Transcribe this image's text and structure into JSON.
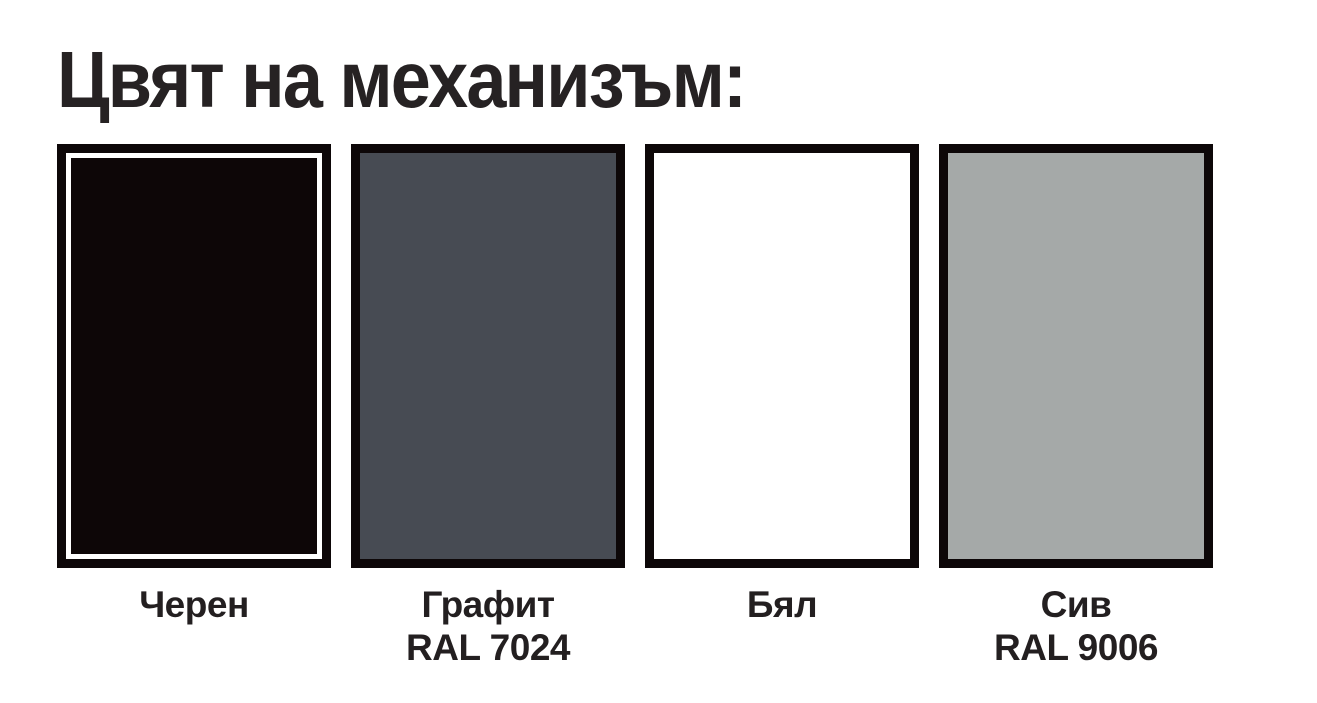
{
  "title": "Цвят на механизъм:",
  "swatches": [
    {
      "label": "Черен",
      "ral": "",
      "color": "#0d0607",
      "inner_ring_color": "#ffffff"
    },
    {
      "label": "Графит",
      "ral": "RAL 7024",
      "color": "#474b53",
      "inner_ring_color": ""
    },
    {
      "label": "Бял",
      "ral": "",
      "color": "#ffffff",
      "inner_ring_color": ""
    },
    {
      "label": "Сив",
      "ral": "RAL 9006",
      "color": "#a5a9a8",
      "inner_ring_color": ""
    }
  ],
  "colors": {
    "title_text": "#262223",
    "label_text": "#231f20",
    "swatch_border": "#0d0708",
    "background": "#ffffff"
  }
}
